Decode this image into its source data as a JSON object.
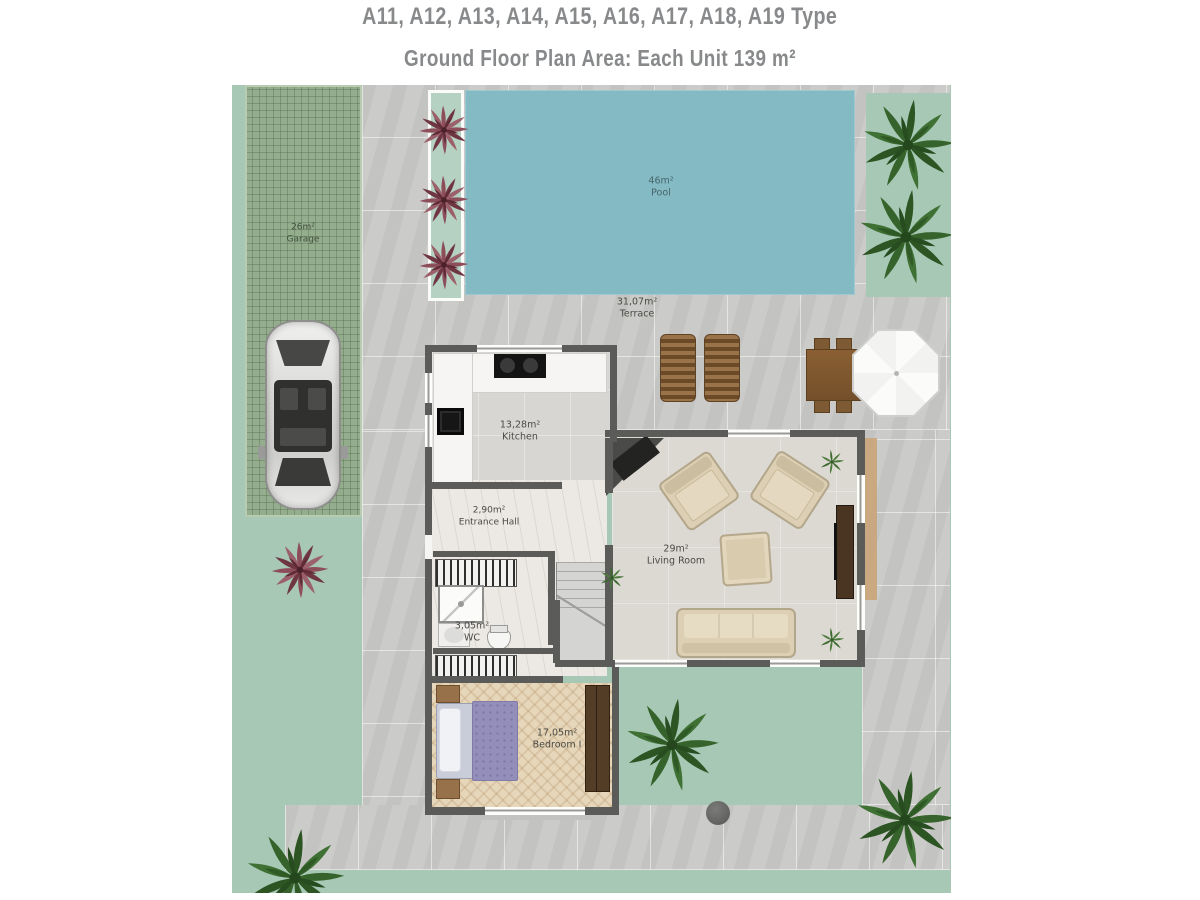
{
  "title": {
    "line1": "A11, A12, A13, A14, A15, A16, A17, A18, A19 Type",
    "line2": "Ground Floor Plan Area: Each Unit 139 m²"
  },
  "rooms": [
    {
      "id": "garage",
      "area": "26m²",
      "name": "Garage"
    },
    {
      "id": "pool",
      "area": "46m²",
      "name": "Pool"
    },
    {
      "id": "terrace",
      "area": "31,07m²",
      "name": "Terrace"
    },
    {
      "id": "kitchen",
      "area": "13,28m²",
      "name": "Kitchen"
    },
    {
      "id": "entrance-hall",
      "area": "2,90m²",
      "name": "Entrance Hall"
    },
    {
      "id": "wc",
      "area": "3,05m²",
      "name": "WC"
    },
    {
      "id": "living-room",
      "area": "29m²",
      "name": "Living Room"
    },
    {
      "id": "bedroom",
      "area": "17,05m²",
      "name": "Bedroom I"
    }
  ],
  "colors": {
    "lawn": "#a6c8b5",
    "pool_water": "#84bac4",
    "paving": "#c9c9c7",
    "garage_paving": "#94ad8c",
    "wall": "#5b5b5a",
    "wood": "#8a5f36",
    "palm_green": "#35632b",
    "flower_red": "#8d4e5a",
    "title_text": "#87898b"
  }
}
